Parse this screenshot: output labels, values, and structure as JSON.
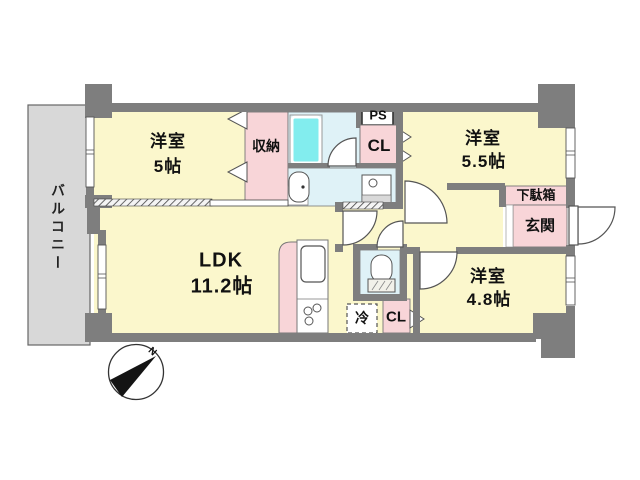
{
  "plan": {
    "type": "apartment-floor-plan",
    "rooms": {
      "bedroom5": {
        "name": "洋室",
        "size": "5帖"
      },
      "bedroom55": {
        "name": "洋室",
        "size": "5.5帖"
      },
      "bedroom48": {
        "name": "洋室",
        "size": "4.8帖"
      },
      "ldk": {
        "name": "LDK",
        "size": "11.2帖"
      }
    },
    "labels": {
      "balcony": "バルコニー",
      "storage": "収納",
      "pipe_space": "PS",
      "closet_upper": "CL",
      "closet_lower": "CL",
      "shoe_cabinet": "下駄箱",
      "entrance": "玄関",
      "refrigerator": "冷",
      "north": "N"
    },
    "colors": {
      "room_yellow": "#FBF7CC",
      "closet_pink": "#F8D5D8",
      "wet_area_blue": "#DFF2F7",
      "bathtub_cyan": "#82EDEE",
      "balcony_gray": "#D8D8D8",
      "wall_gray": "#7E7E7E"
    }
  }
}
